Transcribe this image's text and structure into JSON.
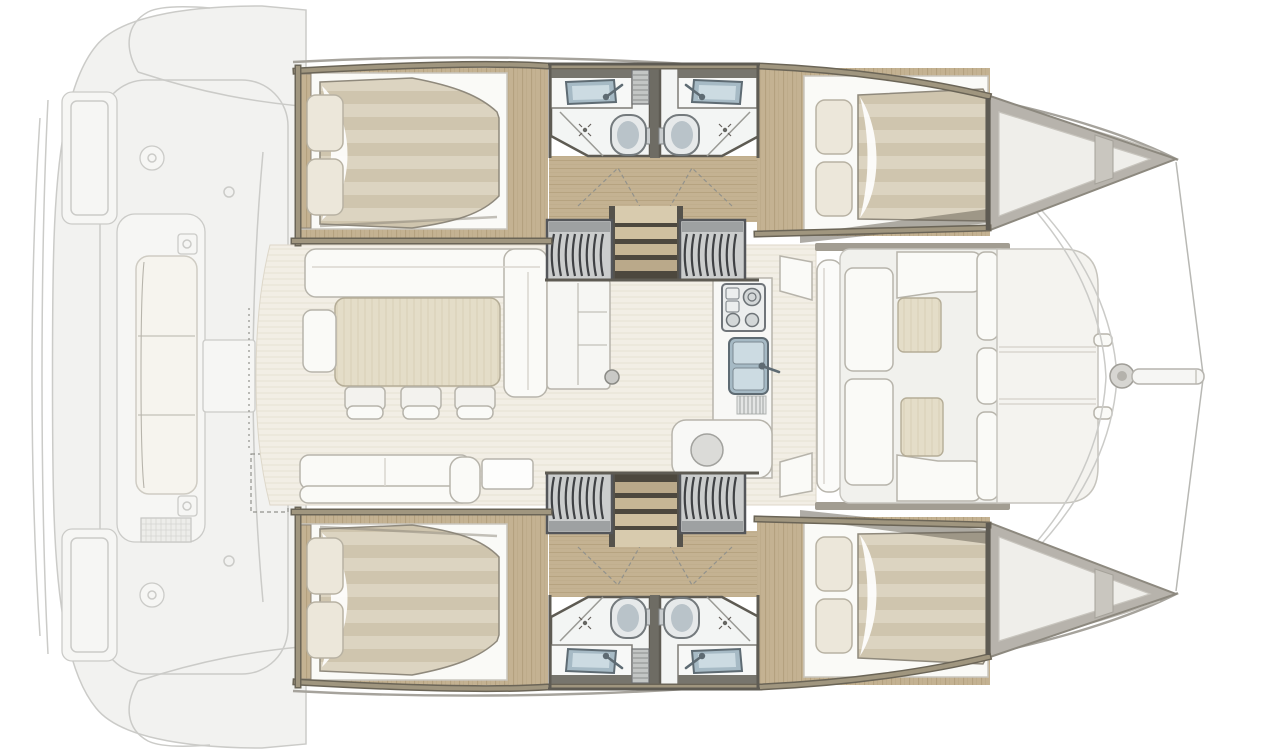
{
  "title": "catamaran-interior-layout-plan",
  "vessel": "sailing-catamaran floor plan, bow to the right, aft cockpit ghosted at left",
  "palette": {
    "background": "#ffffff",
    "ghost_fill": "#f2f2f0",
    "ghost_line": "#cbcbc8",
    "wall_wood": "#a0967f",
    "wall_wood_edge": "#6b6557",
    "wall_dark": "#5e5b53",
    "wood_floor": "#c4b292",
    "wood_grain": "#a8946e",
    "salon_floor": "#f2eee5",
    "salon_floor_line": "#e4decf",
    "mattress": "#dcd4c1",
    "mattress_stripe": "#cfc5ae",
    "pillow": "#ece7da",
    "pillow_edge": "#b8b2a3",
    "furniture_white": "#fafaf7",
    "furniture_outline": "#b7b4ab",
    "table_beige": "#e4ddc8",
    "table_edge": "#b5ad97",
    "locker_gray": "#cbcdcd",
    "locker_rib": "#3f4144",
    "locker_frame": "#54565a",
    "steel": "#a6bac5",
    "steel_dark": "#5e6b73",
    "steel_light": "#ccdbe2",
    "toilet_body": "#e6e9ea",
    "toilet_inner": "#b9c3c9",
    "bath_floor": "#f3f5f4",
    "step": "#d8cbae",
    "step_shadow": "#35322b",
    "deck_band": "#a29d92",
    "bow_fill": "#b7b3ac",
    "shadow": "#5f594e"
  },
  "features": [
    {
      "id": "aft-cockpit",
      "name": "aft cockpit with bench (ghosted)"
    },
    {
      "id": "saloon",
      "name": "saloon with L-sofa, dining table and three chairs"
    },
    {
      "id": "galley",
      "name": "galley with stove, double sink and round basin module"
    },
    {
      "id": "cabins",
      "name": "four double cabins with pillows and striped duvets"
    },
    {
      "id": "bathrooms",
      "name": "four shower rooms with WC, basin and shower"
    },
    {
      "id": "staircases",
      "name": "two companionway staircases to the hulls"
    },
    {
      "id": "lockers",
      "name": "tambour lockers beside each staircase"
    },
    {
      "id": "forward-cockpit",
      "name": "forward cockpit lounge with two ottomans"
    },
    {
      "id": "foredeck",
      "name": "foredeck sunpads, mast base, bowsprit, trampoline beams"
    }
  ]
}
